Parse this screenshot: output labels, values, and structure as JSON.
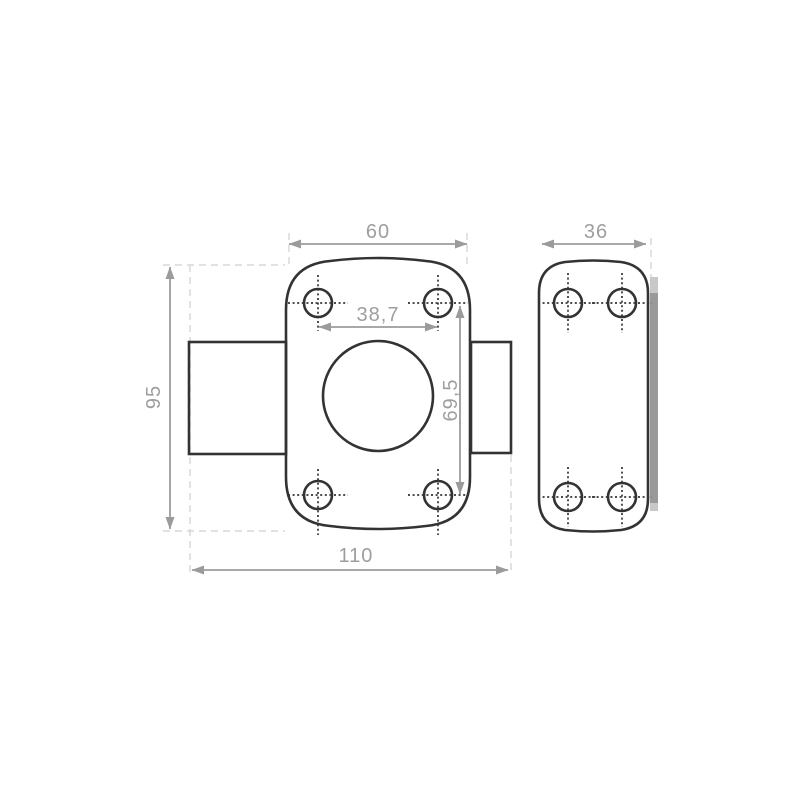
{
  "drawing": {
    "kind": "technical dimension drawing",
    "subject": "rim lock body with cylinder housing and strike plate",
    "colors": {
      "background": "#ffffff",
      "outline": "#333333",
      "dimension": "#9b9b9b",
      "dimension_text": "#9e9e9e",
      "extension_dash": "#d8d8d8",
      "edge_bar": "#999999",
      "edge_bar_cap": "#c8c8c8"
    },
    "dimensions": {
      "body_width": "60",
      "plate_width": "36",
      "body_height": "95",
      "hole_pitch_horizontal": "38,7",
      "hole_pitch_vertical": "69,5",
      "overall_width": "110"
    }
  }
}
